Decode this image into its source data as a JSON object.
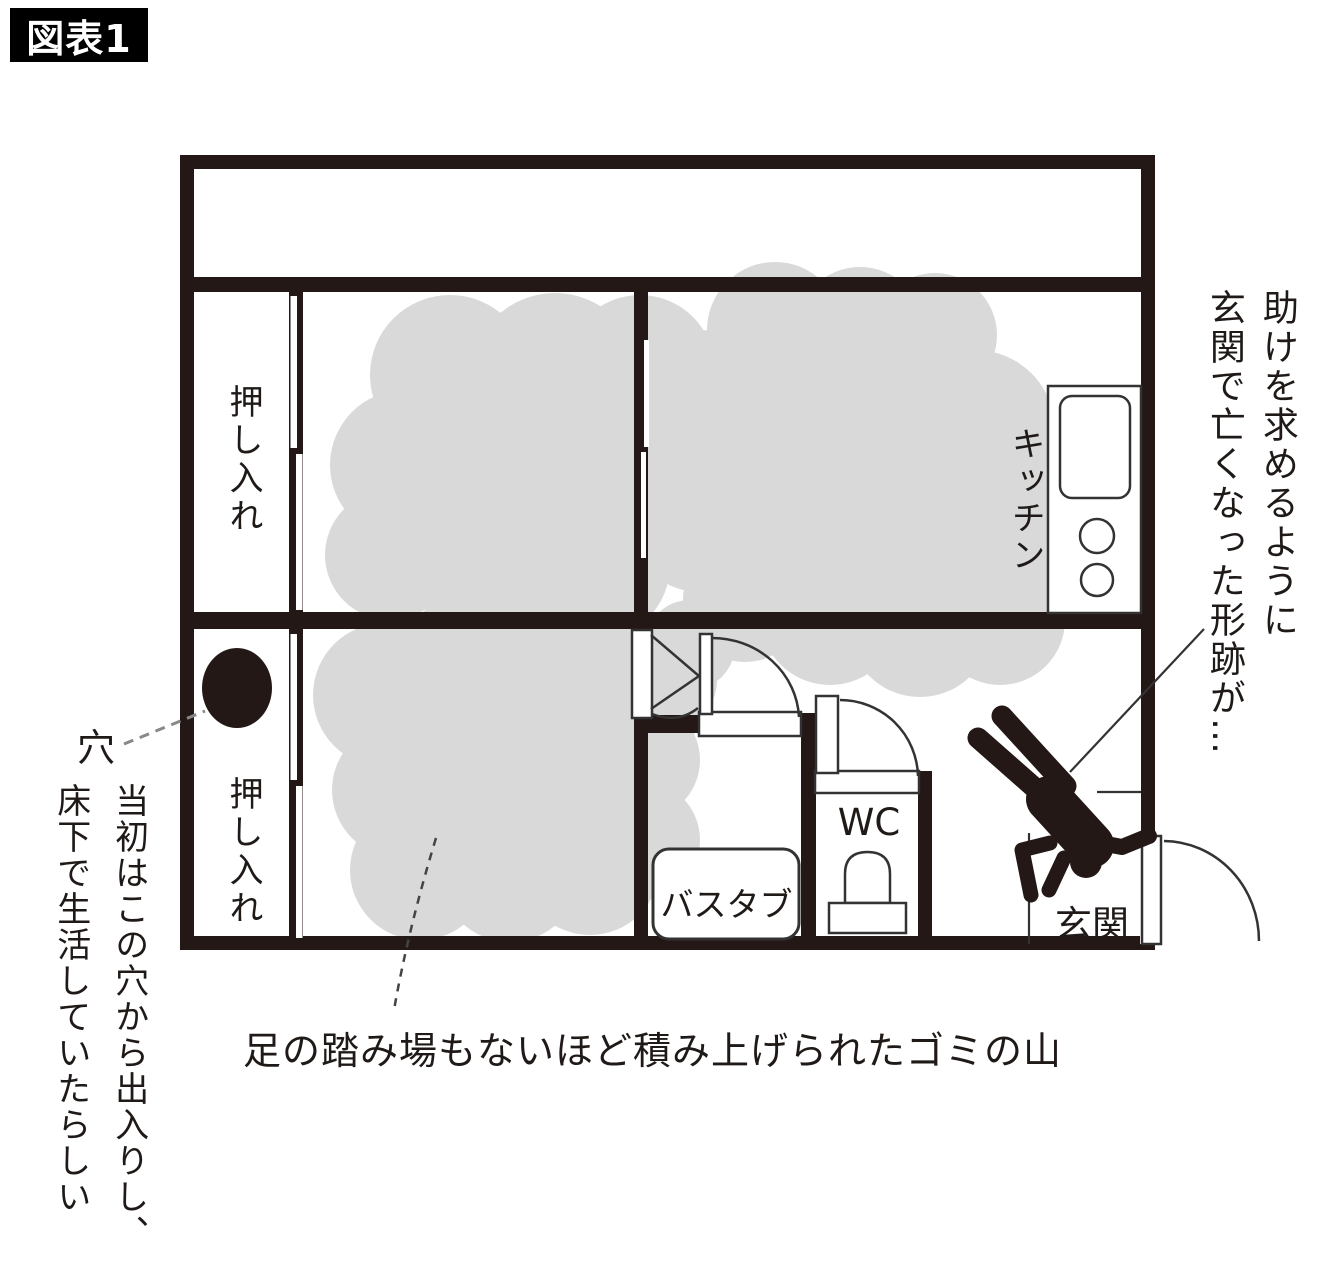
{
  "figure_badge": "図表1",
  "plan": {
    "rooms": {
      "closet_top_label": "押し入れ",
      "closet_bottom_label": "押し入れ",
      "kitchen_label": "キッチン",
      "wc_label": "WC",
      "bathtub_label": "バスタブ",
      "entrance_label": "玄関",
      "hole_label": "穴"
    },
    "annotations": {
      "right_line1": "助けを求めるように",
      "right_line2": "玄関で亡くなった形跡が…",
      "left_line1": "当初はこの穴から出入りし、",
      "left_line2": "床下で生活していたらしい",
      "bottom_caption": "足の踏み場もないほど積み上げられたゴミの山"
    },
    "colors": {
      "wall": "#231815",
      "garbage_cloud": "#d9d9d9",
      "background": "#ffffff",
      "badge_bg": "#000000",
      "badge_text": "#ffffff"
    }
  }
}
